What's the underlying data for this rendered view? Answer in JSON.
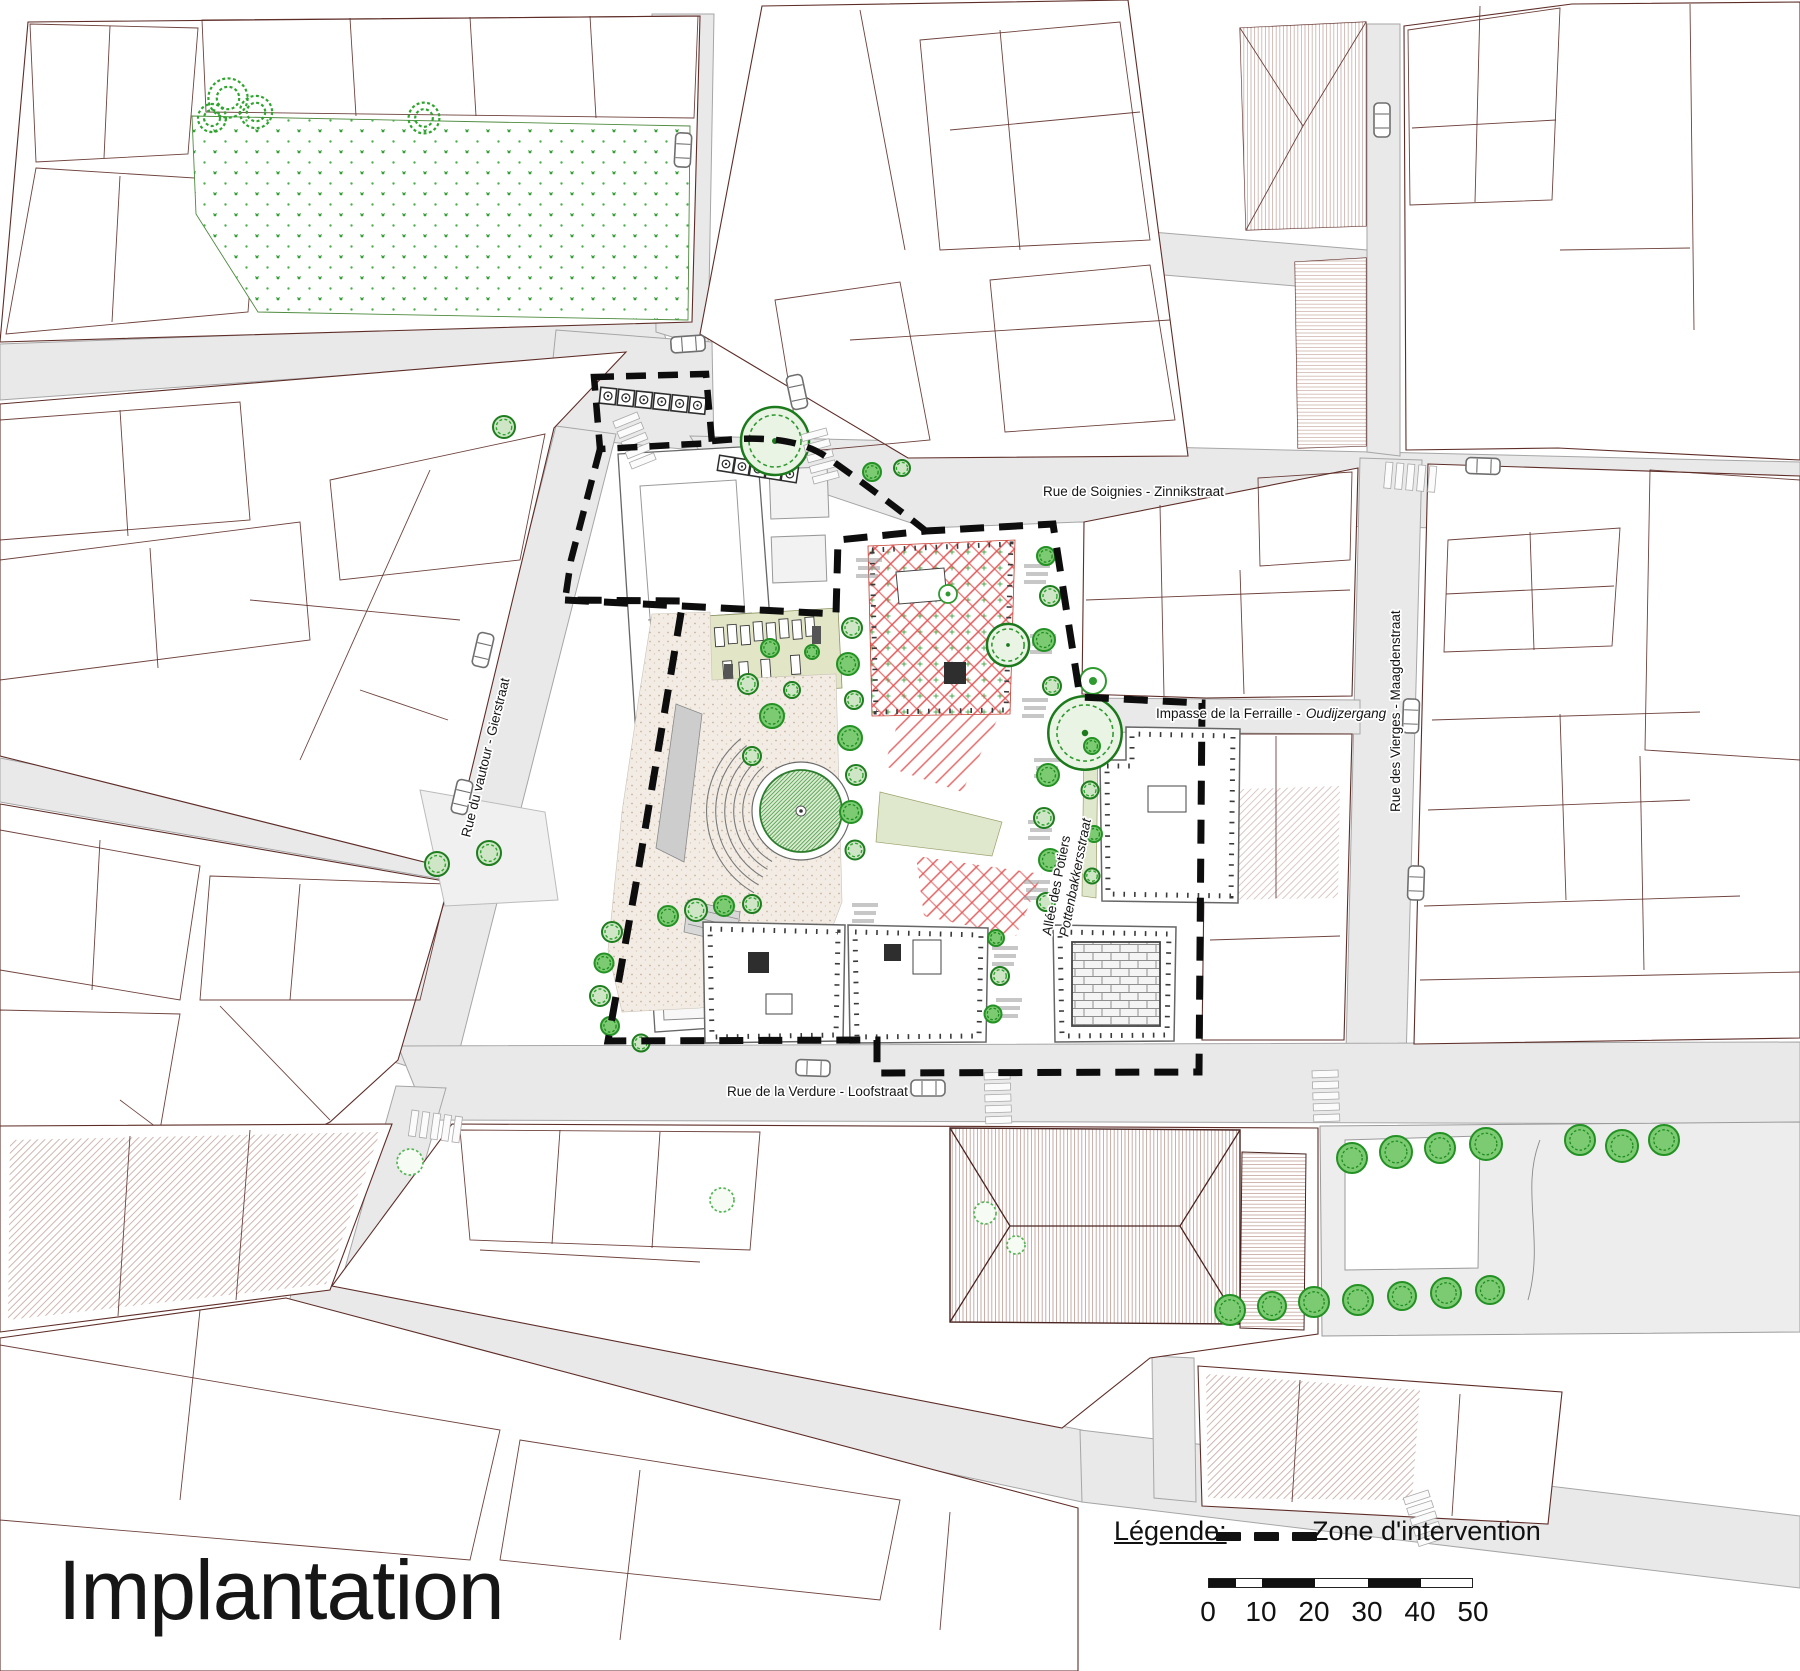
{
  "title": "Implantation",
  "legend": {
    "heading": "Légende:",
    "zone_label": "Zone d'intervention"
  },
  "scale_bar": {
    "ticks": [
      "0",
      "10",
      "20",
      "30",
      "40",
      "50"
    ]
  },
  "streets": {
    "zinnikstraat": "Rue de Soignies - Zinnikstraat",
    "gierstraat": "Rue du vautour - Gierstraat",
    "maagdenstraat": "Rue des Vierges - Maagdenstraat",
    "impasse_fr": "Impasse de la Ferraille -",
    "impasse_nl": "Oudijzergang",
    "potiers_fr": "Allée des Potiers",
    "potiers_nl": "Pottenbakkersstraat",
    "loofstraat": "Rue de la Verdure - Loofstraat"
  },
  "colors": {
    "tree_green": "#2f9a2f",
    "red_hatch": "#e25050",
    "zone_boundary": "#0d0d0d",
    "street_gray": "#e9e9e9",
    "parcel_outline": "#5e2d28"
  }
}
